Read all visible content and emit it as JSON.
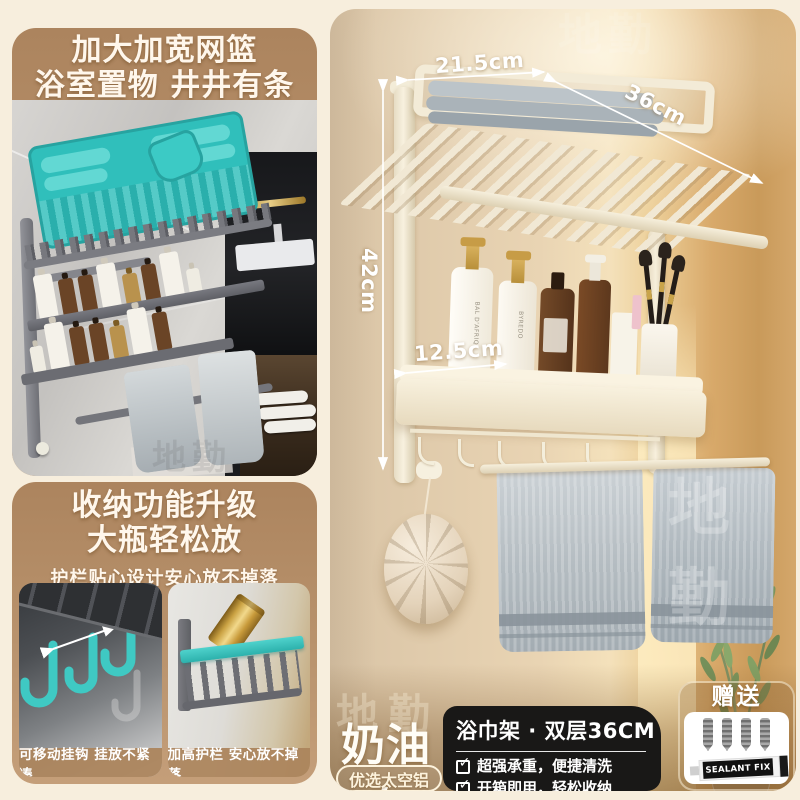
{
  "left_column": {
    "panel_top": {
      "title_line1": "加大加宽网篮",
      "title_line2": "浴室置物 井井有条"
    },
    "panel_bottom": {
      "title_line1": "收纳功能升级",
      "title_line2": "大瓶轻松放",
      "subtitle": "护栏贴心设计安心放不掉落",
      "caption_left": "可移动挂钩 挂放不紧凑",
      "caption_right": "加高护栏 安心放不掉落"
    }
  },
  "right_panel": {
    "dimensions": {
      "top_width": "21.5cm",
      "depth": "36cm",
      "height": "42cm",
      "shelf_depth": "12.5cm"
    },
    "bottle": {
      "brand": "BYREDO",
      "name": "BAL D'AFRIQ"
    },
    "color_name": "奶油白",
    "material_badge": "优选太空铝",
    "product_card": {
      "title": "浴巾架 · 双层36CM",
      "check_icon": "✓",
      "feature_1": "超强承重，便捷清洗",
      "feature_2": "开箱即用，轻松收纳"
    },
    "gift": {
      "label": "赠送",
      "tube_text": "SEALANT FIX"
    }
  },
  "watermark": "地勤",
  "colors": {
    "accent_teal": "#3cc8c2",
    "panel_tan": "#b28d65",
    "cream_background": "#f7eedd",
    "card_dark": "#191817"
  }
}
